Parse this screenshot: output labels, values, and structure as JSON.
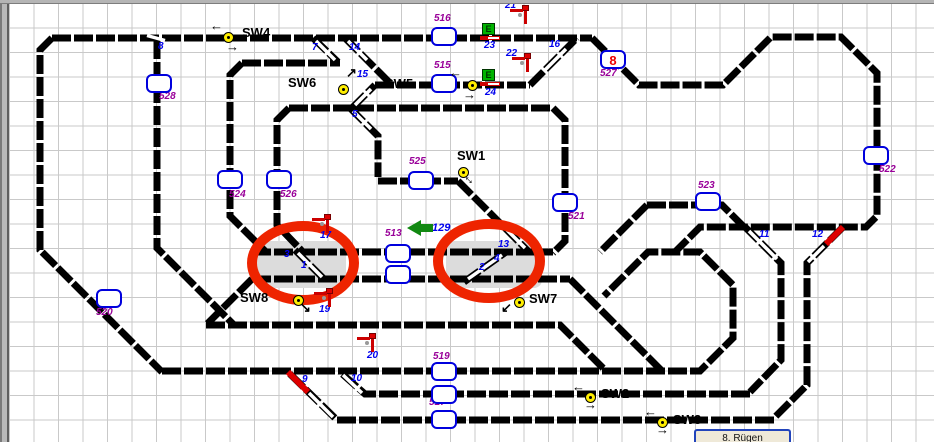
{
  "tab": {
    "label": "8. Rügen",
    "x": 694,
    "y": 429,
    "w": 97,
    "h": 13
  },
  "colors": {
    "track": "#000000",
    "highlight": "#ee2400",
    "block_border": "#0000dd",
    "switch_number": "#0000ee",
    "block_number": "#990099",
    "train_red": "#ee0000",
    "train_green": "#118811",
    "switch_circle": "#ffee00",
    "signal_red": "#cc0000",
    "entry_green": "#00b400",
    "station_shade": "#dcdcdc"
  },
  "labels": [
    {
      "name": "label-sw4",
      "text": "SW4",
      "x": 242,
      "y": 26,
      "cls": "sw"
    },
    {
      "name": "label-sw6",
      "text": "SW6",
      "x": 288,
      "y": 76,
      "cls": "sw"
    },
    {
      "name": "label-sw5",
      "text": "SW5",
      "x": 385,
      "y": 77,
      "cls": "sw"
    },
    {
      "name": "label-sw1",
      "text": "SW1",
      "x": 457,
      "y": 149,
      "cls": "sw"
    },
    {
      "name": "label-sw8",
      "text": "SW8",
      "x": 240,
      "y": 291,
      "cls": "sw"
    },
    {
      "name": "label-sw7",
      "text": "SW7",
      "x": 529,
      "y": 292,
      "cls": "sw"
    },
    {
      "name": "label-sw2",
      "text": "SW2",
      "x": 601,
      "y": 387,
      "cls": "sw"
    },
    {
      "name": "label-sw3",
      "text": "SW3",
      "x": 673,
      "y": 413,
      "cls": "sw"
    },
    {
      "name": "switch-number-8",
      "text": "8",
      "x": 158,
      "y": 42,
      "cls": "bnum"
    },
    {
      "name": "switch-number-7",
      "text": "7",
      "x": 312,
      "y": 43,
      "cls": "bnum"
    },
    {
      "name": "switch-number-14",
      "text": "14",
      "x": 349,
      "y": 43,
      "cls": "bnum"
    },
    {
      "name": "switch-number-15",
      "text": "15",
      "x": 357,
      "y": 70,
      "cls": "bnum"
    },
    {
      "name": "switch-number-5",
      "text": "5",
      "x": 352,
      "y": 110,
      "cls": "bnum"
    },
    {
      "name": "switch-number-16",
      "text": "16",
      "x": 549,
      "y": 40,
      "cls": "bnum"
    },
    {
      "name": "signal-number-23",
      "text": "23",
      "x": 484,
      "y": 41,
      "cls": "bnum"
    },
    {
      "name": "signal-number-24",
      "text": "24",
      "x": 485,
      "y": 88,
      "cls": "bnum"
    },
    {
      "name": "signal-number-21",
      "text": "21",
      "x": 505,
      "y": 1,
      "cls": "bnum"
    },
    {
      "name": "signal-number-22",
      "text": "22",
      "x": 506,
      "y": 49,
      "cls": "bnum"
    },
    {
      "name": "switch-number-13",
      "text": "13",
      "x": 498,
      "y": 240,
      "cls": "bnum"
    },
    {
      "name": "switch-number-4",
      "text": "4",
      "x": 494,
      "y": 254,
      "cls": "bnum"
    },
    {
      "name": "switch-number-2",
      "text": "2",
      "x": 479,
      "y": 263,
      "cls": "bnum"
    },
    {
      "name": "switch-number-3",
      "text": "3",
      "x": 284,
      "y": 250,
      "cls": "bnum"
    },
    {
      "name": "switch-number-1",
      "text": "1",
      "x": 301,
      "y": 261,
      "cls": "bnum"
    },
    {
      "name": "signal-number-17",
      "text": "17",
      "x": 320,
      "y": 231,
      "cls": "bnum"
    },
    {
      "name": "signal-number-19",
      "text": "19",
      "x": 319,
      "y": 305,
      "cls": "bnum"
    },
    {
      "name": "signal-number-20",
      "text": "20",
      "x": 367,
      "y": 351,
      "cls": "bnum"
    },
    {
      "name": "switch-number-9",
      "text": "9",
      "x": 302,
      "y": 375,
      "cls": "bnum"
    },
    {
      "name": "switch-number-10",
      "text": "10",
      "x": 351,
      "y": 374,
      "cls": "bnum"
    },
    {
      "name": "switch-number-11",
      "text": "11",
      "x": 759,
      "y": 230,
      "cls": "bnum"
    },
    {
      "name": "switch-number-12",
      "text": "12",
      "x": 812,
      "y": 230,
      "cls": "bnum"
    },
    {
      "name": "train-number-129",
      "text": "129",
      "x": 432,
      "y": 223,
      "cls": "bnum-lg"
    },
    {
      "name": "block-number-516",
      "text": "516",
      "x": 434,
      "y": 14,
      "cls": "pnum"
    },
    {
      "name": "block-number-515",
      "text": "515",
      "x": 434,
      "y": 61,
      "cls": "pnum"
    },
    {
      "name": "block-number-527",
      "text": "527",
      "x": 600,
      "y": 69,
      "cls": "pnum"
    },
    {
      "name": "block-number-528",
      "text": "528",
      "x": 159,
      "y": 92,
      "cls": "pnum"
    },
    {
      "name": "block-number-524",
      "text": "524",
      "x": 229,
      "y": 190,
      "cls": "pnum"
    },
    {
      "name": "block-number-526",
      "text": "526",
      "x": 280,
      "y": 190,
      "cls": "pnum"
    },
    {
      "name": "block-number-525",
      "text": "525",
      "x": 409,
      "y": 157,
      "cls": "pnum"
    },
    {
      "name": "block-number-521",
      "text": "521",
      "x": 568,
      "y": 212,
      "cls": "pnum"
    },
    {
      "name": "block-number-522",
      "text": "522",
      "x": 879,
      "y": 165,
      "cls": "pnum"
    },
    {
      "name": "block-number-523",
      "text": "523",
      "x": 698,
      "y": 181,
      "cls": "pnum"
    },
    {
      "name": "block-number-513",
      "text": "513",
      "x": 385,
      "y": 229,
      "cls": "pnum"
    },
    {
      "name": "block-number-514",
      "text": "514",
      "x": 387,
      "y": 254,
      "cls": "pnum"
    },
    {
      "name": "block-number-519",
      "text": "519",
      "x": 433,
      "y": 352,
      "cls": "pnum"
    },
    {
      "name": "block-number-517",
      "text": "517",
      "x": 429,
      "y": 398,
      "cls": "pnum"
    },
    {
      "name": "block-number-520",
      "text": "520",
      "x": 96,
      "y": 308,
      "cls": "pnum"
    }
  ],
  "blocks": [
    {
      "name": "block-516",
      "x": 431,
      "y": 27
    },
    {
      "name": "block-515",
      "x": 431,
      "y": 74
    },
    {
      "name": "block-527",
      "x": 600,
      "y": 50,
      "occupant": "8"
    },
    {
      "name": "block-528",
      "x": 146,
      "y": 74
    },
    {
      "name": "block-524",
      "x": 217,
      "y": 170
    },
    {
      "name": "block-526",
      "x": 266,
      "y": 170
    },
    {
      "name": "block-525",
      "x": 408,
      "y": 171
    },
    {
      "name": "block-521",
      "x": 552,
      "y": 193
    },
    {
      "name": "block-522",
      "x": 863,
      "y": 146
    },
    {
      "name": "block-523",
      "x": 695,
      "y": 192
    },
    {
      "name": "block-513",
      "x": 385,
      "y": 244
    },
    {
      "name": "block-514",
      "x": 385,
      "y": 265
    },
    {
      "name": "block-519",
      "x": 431,
      "y": 362
    },
    {
      "name": "block-518",
      "x": 431,
      "y": 385
    },
    {
      "name": "block-517",
      "x": 431,
      "y": 410
    },
    {
      "name": "block-520",
      "x": 96,
      "y": 289
    }
  ],
  "switch_circles": [
    {
      "name": "switch-circle-sw4",
      "x": 223,
      "y": 32
    },
    {
      "name": "switch-circle-15",
      "x": 338,
      "y": 84
    },
    {
      "name": "switch-circle-24",
      "x": 467,
      "y": 80
    },
    {
      "name": "switch-circle-sw1",
      "x": 458,
      "y": 167
    },
    {
      "name": "switch-circle-sw8",
      "x": 293,
      "y": 295
    },
    {
      "name": "switch-circle-sw7",
      "x": 514,
      "y": 297
    },
    {
      "name": "switch-circle-sw2",
      "x": 585,
      "y": 392
    },
    {
      "name": "switch-circle-sw3",
      "x": 657,
      "y": 417
    }
  ],
  "arrows": [
    {
      "name": "arrow-sw4-left",
      "glyph": "←",
      "x": 210,
      "y": 19
    },
    {
      "name": "arrow-sw4-right",
      "glyph": "→",
      "x": 226,
      "y": 40
    },
    {
      "name": "arrow-24-left",
      "glyph": "←",
      "x": 449,
      "y": 66
    },
    {
      "name": "arrow-24-right",
      "glyph": "→",
      "x": 463,
      "y": 88
    },
    {
      "name": "arrow-15-up",
      "glyph": "↗",
      "x": 346,
      "y": 66
    },
    {
      "name": "arrow-sw1-diag",
      "glyph": "↔",
      "x": 464,
      "y": 172,
      "rot": 45
    },
    {
      "name": "arrow-sw8",
      "glyph": "↘",
      "x": 300,
      "y": 301
    },
    {
      "name": "arrow-sw7",
      "glyph": "↙",
      "x": 501,
      "y": 301
    },
    {
      "name": "arrow-sw2-left",
      "glyph": "←",
      "x": 572,
      "y": 380
    },
    {
      "name": "arrow-sw2-right",
      "glyph": "→",
      "x": 584,
      "y": 398
    },
    {
      "name": "arrow-sw3-left",
      "glyph": "←",
      "x": 644,
      "y": 405
    },
    {
      "name": "arrow-sw3-right",
      "glyph": "→",
      "x": 656,
      "y": 423
    }
  ],
  "signals": [
    {
      "name": "signal-21",
      "x": 510,
      "y": 5
    },
    {
      "name": "signal-22",
      "x": 512,
      "y": 53
    },
    {
      "name": "signal-17",
      "x": 312,
      "y": 214
    },
    {
      "name": "signal-19",
      "x": 314,
      "y": 288
    },
    {
      "name": "signal-20",
      "x": 357,
      "y": 333
    }
  ],
  "entry_signals": [
    {
      "name": "entry-signal-23",
      "letter": "E",
      "x": 480,
      "y": 23
    },
    {
      "name": "entry-signal-24",
      "letter": "E",
      "x": 480,
      "y": 69
    }
  ],
  "train_arrow": {
    "name": "train-arrow-129",
    "x": 407,
    "y": 220
  }
}
